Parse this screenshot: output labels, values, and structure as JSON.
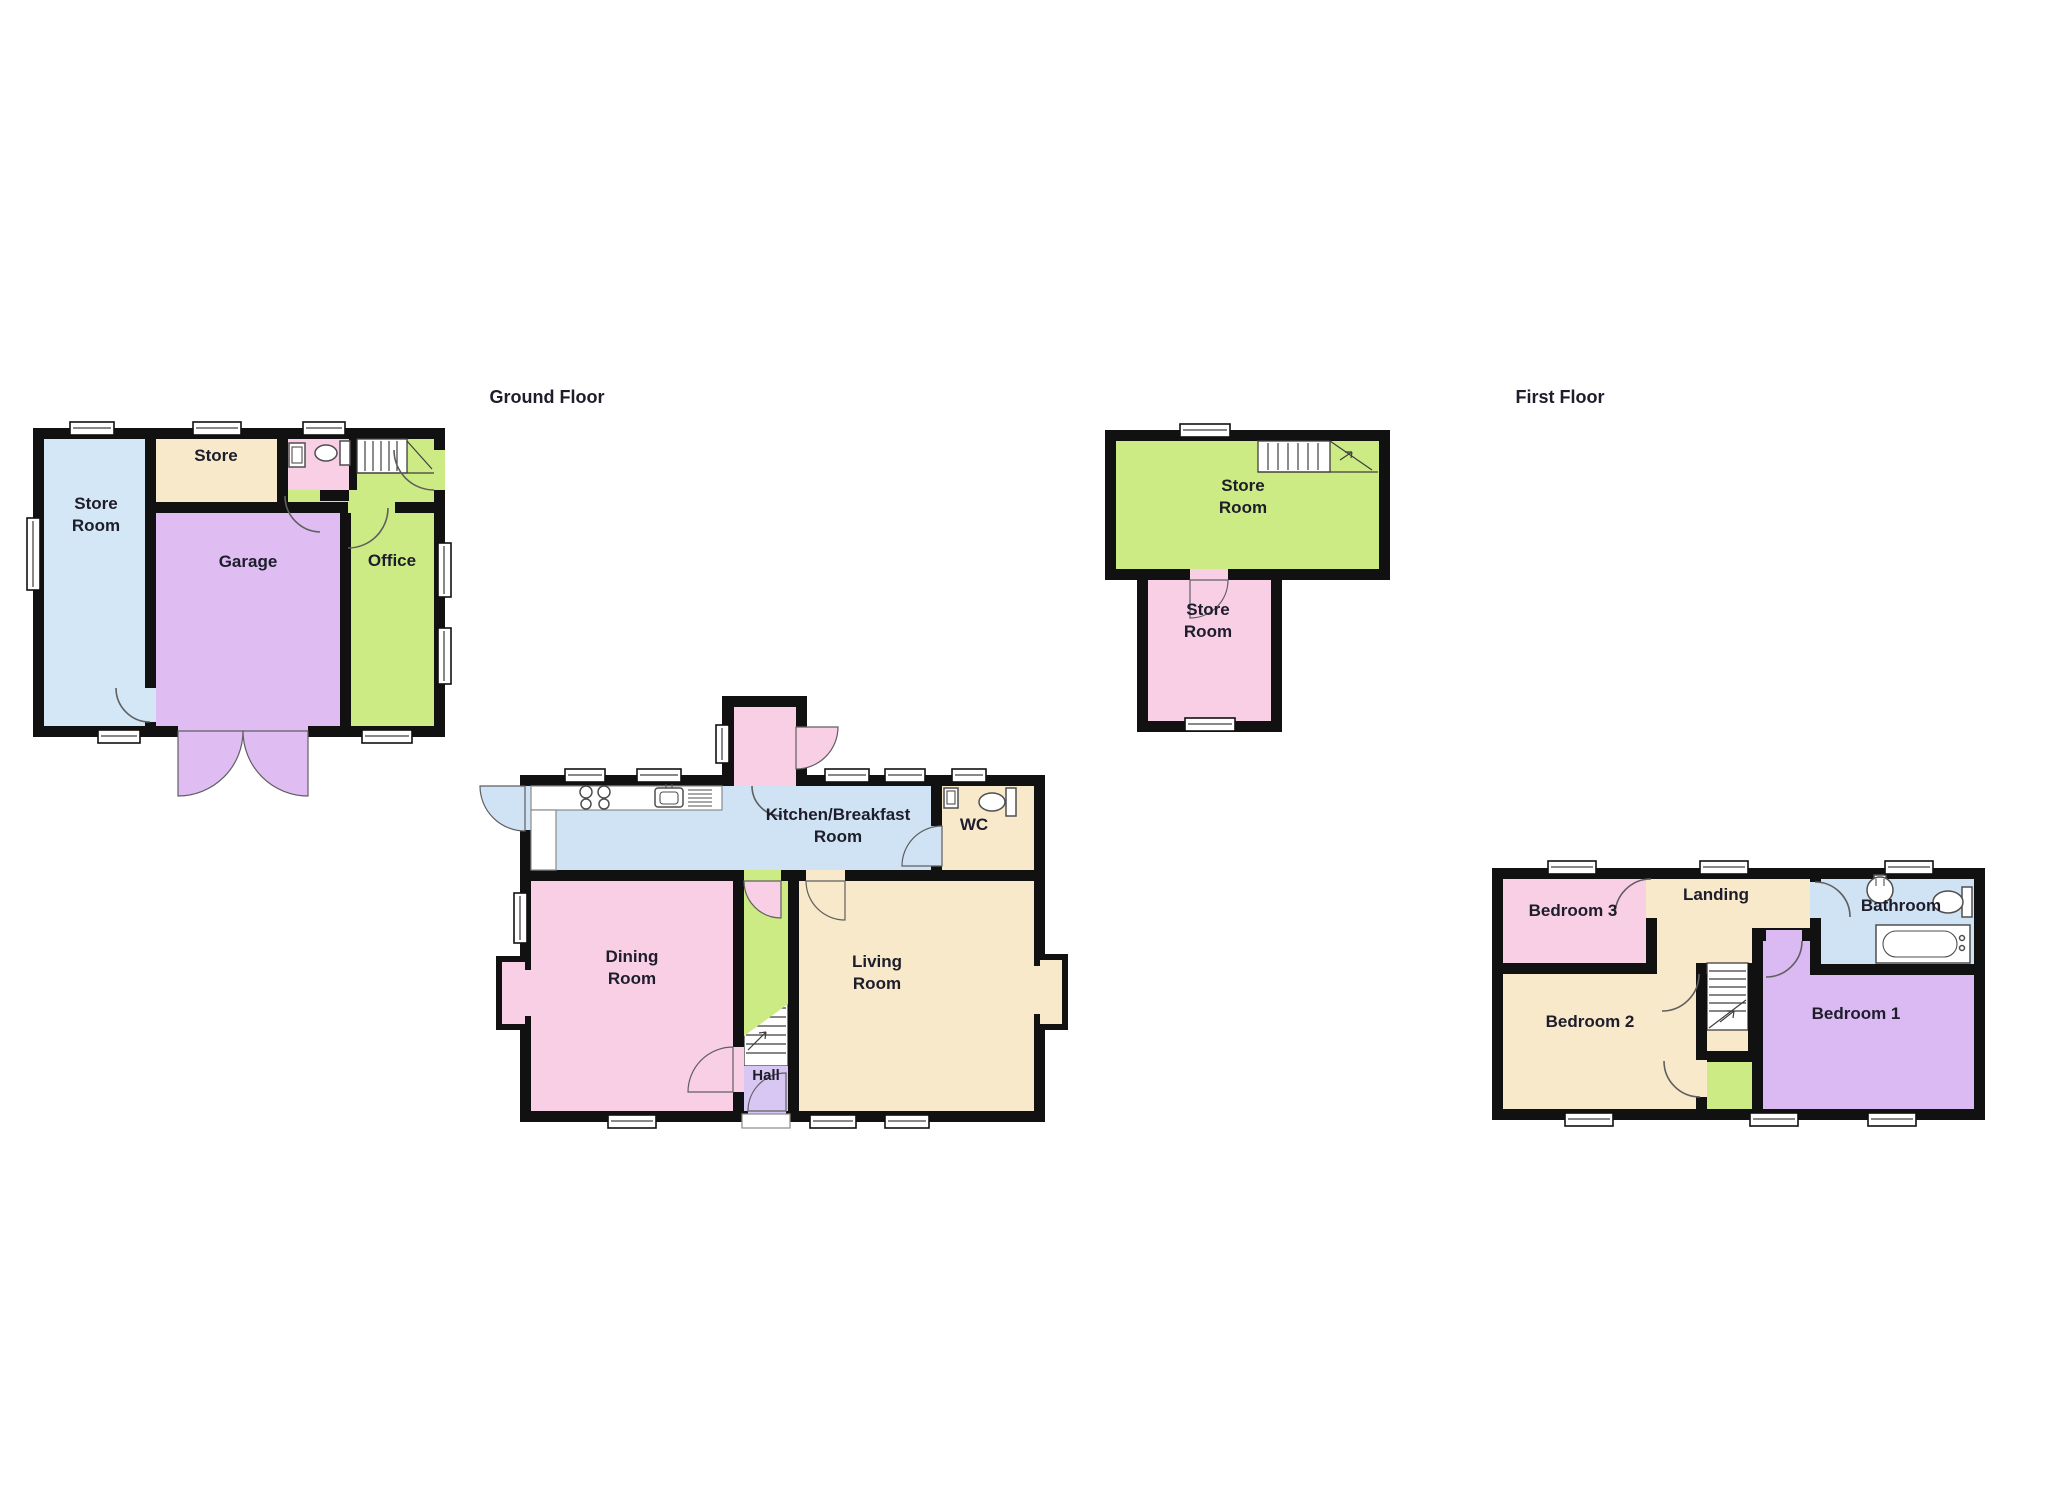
{
  "palette": {
    "page_bg": "#ffffff",
    "wall": "#111111",
    "window_fill": "#ffffff",
    "door": "#5f5f5f",
    "fixture": "#4f4f4f",
    "stair": "#3f3f3f",
    "label": "#1d1d2b"
  },
  "titles": {
    "ground": "Ground Floor",
    "first": "First Floor"
  },
  "rooms": {
    "out_store_room": {
      "line1": "Store",
      "line2": "Room",
      "color": "#d4e7f7"
    },
    "out_store": {
      "label": "Store",
      "color": "#f8e9cb"
    },
    "garage": {
      "label": "Garage",
      "color": "#dfbdf2"
    },
    "office": {
      "label": "Office",
      "color": "#cdeb84"
    },
    "out_wc": {
      "color": "#f9cfe6"
    },
    "kitchen": {
      "line1": "Kitchen/Breakfast",
      "line2": "Room",
      "color": "#cfe3f5"
    },
    "wc": {
      "label": "WC",
      "color": "#f8e9cb"
    },
    "dining": {
      "line1": "Dining",
      "line2": "Room",
      "color": "#f9cfe6"
    },
    "living": {
      "line1": "Living",
      "line2": "Room",
      "color": "#f8e9cb"
    },
    "hall": {
      "label": "Hall",
      "color": "#d8c7f2"
    },
    "porch": {
      "color": "#f9cfe6"
    },
    "stairwell_strip": {
      "color": "#cdeb84"
    },
    "store_upper": {
      "line1": "Store",
      "line2": "Room",
      "color": "#cdeb84"
    },
    "store_lower": {
      "line1": "Store",
      "line2": "Room",
      "color": "#f9cfe6"
    },
    "bedroom3": {
      "label": "Bedroom 3",
      "color": "#f9cfe6"
    },
    "landing": {
      "label": "Landing",
      "color": "#f8e9cb"
    },
    "bathroom": {
      "label": "Bathroom",
      "color": "#cfe3f5"
    },
    "bedroom2": {
      "label": "Bedroom 2",
      "color": "#f8e9cb"
    },
    "bedroom1": {
      "label": "Bedroom 1",
      "color": "#dbb9f2"
    },
    "cupboard": {
      "color": "#cdeb84"
    }
  }
}
